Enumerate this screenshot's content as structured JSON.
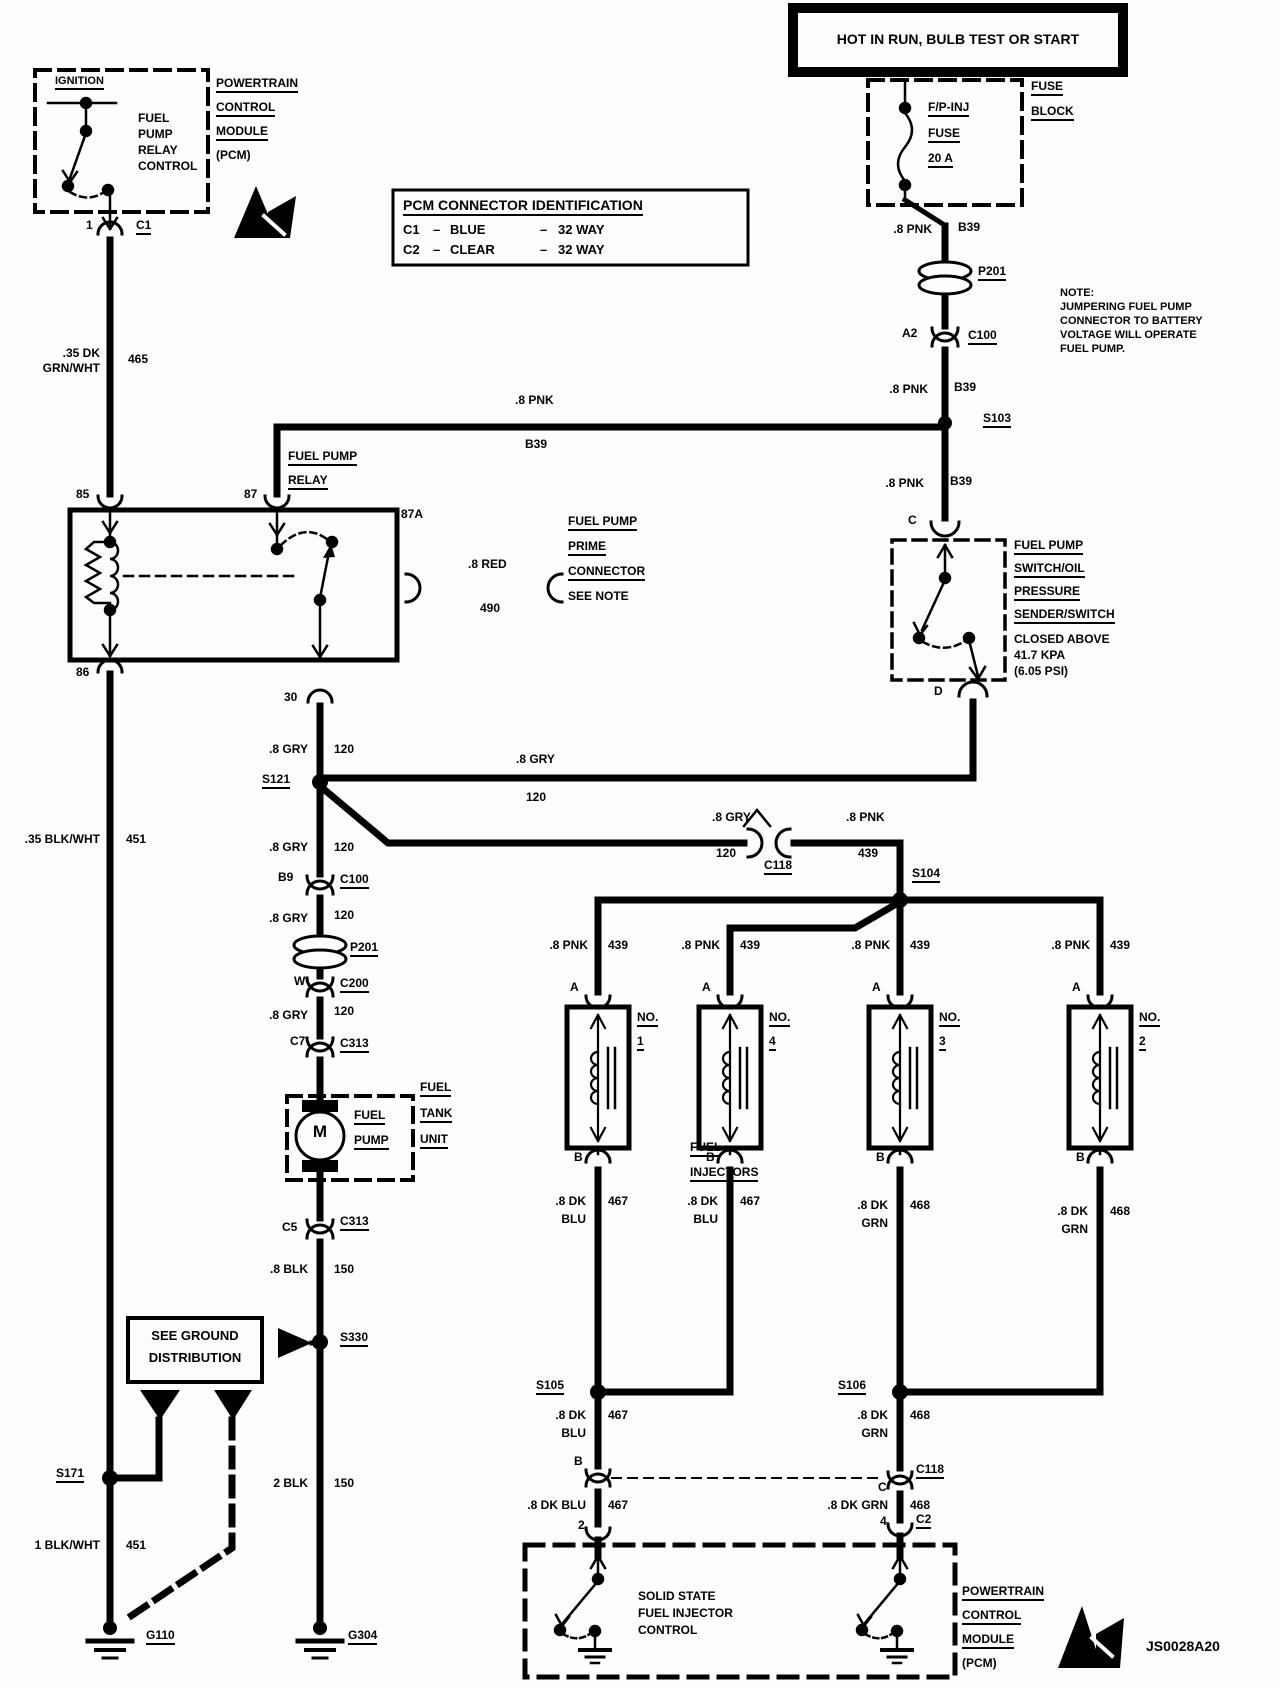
{
  "doc_id": "JS0028A20",
  "hot_box": "HOT IN RUN, BULB TEST OR START",
  "fuse": {
    "name": "F/P-INJ",
    "type": "FUSE",
    "rating": "20 A",
    "block0": "FUSE",
    "block1": "BLOCK"
  },
  "conn_id": {
    "title": "PCM CONNECTOR IDENTIFICATION",
    "rows": [
      {
        "id": "C1",
        "d1": "–",
        "color": "BLUE",
        "d2": "–",
        "ways": "32 WAY"
      },
      {
        "id": "C2",
        "d1": "–",
        "color": "CLEAR",
        "d2": "–",
        "ways": "32 WAY"
      }
    ]
  },
  "note": "NOTE:\nJUMPERING FUEL PUMP\nCONNECTOR TO BATTERY\nVOLTAGE WILL OPERATE\nFUEL PUMP.",
  "pcm_top": {
    "ignition": "IGNITION",
    "fprc": "FUEL\nPUMP\nRELAY\nCONTROL",
    "name0": "POWERTRAIN",
    "name1": "CONTROL",
    "name2": "MODULE",
    "name3": "(PCM)",
    "pin1": "1",
    "c1": "C1"
  },
  "relay": {
    "name0": "FUEL PUMP",
    "name1": "RELAY",
    "p85": "85",
    "p87": "87",
    "p87a": "87A",
    "p86": "86",
    "p30": "30"
  },
  "prime": {
    "l0": "FUEL PUMP",
    "l1": "PRIME",
    "l2": "CONNECTOR",
    "l3": "SEE NOTE"
  },
  "sw": {
    "pinc": "C",
    "pind": "D",
    "n0": "FUEL PUMP",
    "n1": "SWITCH/OIL",
    "n2": "PRESSURE",
    "n3": "SENDER/SWITCH",
    "d0": "CLOSED ABOVE",
    "d1": "41.7 KPA",
    "d2": "(6.05 PSI)"
  },
  "splices": {
    "s103": "S103",
    "s121": "S121",
    "s104": "S104",
    "s105": "S105",
    "s106": "S106",
    "s330": "S330",
    "s171": "S171"
  },
  "conns": {
    "p201a": "P201",
    "a2": "A2",
    "c100a": "C100",
    "b9": "B9",
    "c100b": "C100",
    "p201b": "P201",
    "w": "W",
    "c200": "C200",
    "c7": "C7",
    "c313a": "C313",
    "c5": "C5",
    "c313b": "C313",
    "c118a": "C118",
    "c118b": "C118",
    "c2": "C2",
    "pin2": "2",
    "pin4": "4",
    "pinb": "B",
    "pinc": "C"
  },
  "w": {
    "grnwht": [
      ".35 DK\nGRN/WHT",
      "465"
    ],
    "pnk_run": [
      ".8 PNK",
      "B39"
    ],
    "pnk_a": [
      ".8 PNK",
      "B39"
    ],
    "pnk_b": [
      ".8 PNK",
      "B39"
    ],
    "pnk_c": [
      ".8 PNK",
      "B39"
    ],
    "red": [
      ".8 RED",
      "490"
    ],
    "gry_a": [
      ".8 GRY",
      "120"
    ],
    "gry_d": [
      ".8 GRY",
      "120"
    ],
    "gry_b": [
      ".8 GRY",
      "120"
    ],
    "gry_c": [
      ".8 GRY",
      "120"
    ],
    "gry_e": [
      ".8 GRY",
      "120"
    ],
    "gry_c118": [
      ".8 GRY",
      "120"
    ],
    "pnk_c118": [
      ".8 PNK",
      "439"
    ],
    "blkwht_35": [
      ".35 BLK/WHT",
      "451"
    ],
    "blk_8": [
      ".8 BLK",
      "150"
    ],
    "blkwht_1": [
      "1 BLK/WHT",
      "451"
    ],
    "blk_2": [
      "2 BLK",
      "150"
    ],
    "s105w": [
      ".8 DK",
      "BLU",
      "467"
    ],
    "s106w": [
      ".8 DK",
      "GRN",
      "468"
    ],
    "c2l": [
      ".8 DK BLU",
      "467"
    ],
    "c2r": [
      ".8 DK GRN",
      "468"
    ]
  },
  "pump": {
    "m": "M",
    "l0": "FUEL",
    "l1": "PUMP",
    "u0": "FUEL",
    "u1": "TANK",
    "u2": "UNIT"
  },
  "ground_box": {
    "l0": "SEE GROUND",
    "l1": "DISTRIBUTION"
  },
  "grounds": {
    "g110": "G110",
    "g304": "G304"
  },
  "injectors": {
    "t0": "FUEL",
    "t1": "INJECTORS",
    "pina": "A",
    "pinb": "B",
    "no": "NO.",
    "units": [
      {
        "num": "1",
        "feed": [
          ".8 PNK",
          "439"
        ],
        "out": [
          ".8 DK",
          "BLU",
          "467"
        ]
      },
      {
        "num": "4",
        "feed": [
          ".8 PNK",
          "439"
        ],
        "out": [
          ".8 DK",
          "BLU",
          "467"
        ]
      },
      {
        "num": "3",
        "feed": [
          ".8 PNK",
          "439"
        ],
        "out": [
          ".8 DK",
          "GRN",
          "468"
        ]
      },
      {
        "num": "2",
        "feed": [
          ".8 PNK",
          "439"
        ],
        "out": [
          ".8 DK",
          "GRN",
          "468"
        ]
      }
    ]
  },
  "pcm_bottom": {
    "control": "SOLID STATE\nFUEL INJECTOR\nCONTROL",
    "name0": "POWERTRAIN",
    "name1": "CONTROL",
    "name2": "MODULE",
    "name3": "(PCM)"
  }
}
